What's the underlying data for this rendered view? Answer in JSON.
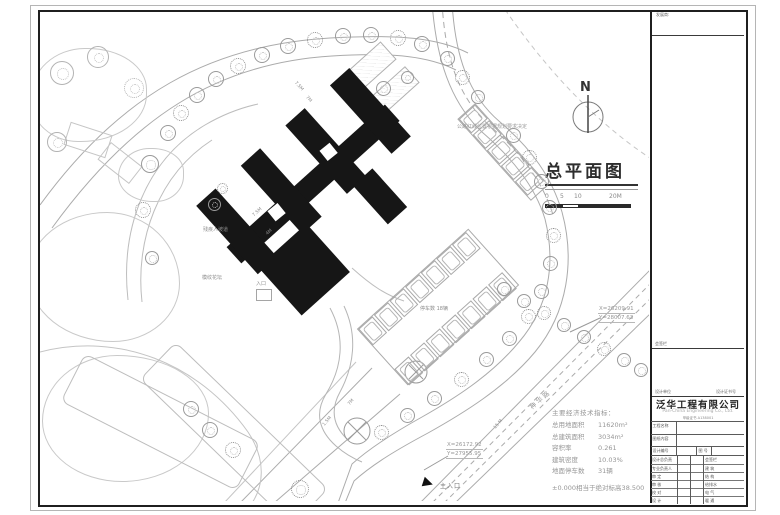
{
  "drawing": {
    "title": "总平面图",
    "north_label": "N",
    "scale_ticks": [
      "0",
      "5",
      "10",
      "20M"
    ],
    "road_note": "公路红线位置根据规划要求决定",
    "road_name": "神华路",
    "coord_markers": [
      {
        "x": "X=26209.91",
        "y": "Y=28007.63"
      },
      {
        "x": "X=26172.92",
        "y": "Y=27955.95"
      }
    ],
    "labels": {
      "main_entrance": "主入口",
      "entrance": "入口",
      "ramp": "残疾人坡道",
      "flower_bed": "模纹花坛",
      "parking_count": "停车数 18辆"
    },
    "dimensions": [
      "7.5M",
      "7M",
      "7.5M",
      "4M",
      "1.5M",
      "7M",
      "15 M"
    ],
    "indicators": {
      "heading": "主要经济技术指标：",
      "rows": [
        {
          "label": "总用地面积",
          "value": "11620m²"
        },
        {
          "label": "总建筑面积",
          "value": "3034m²"
        },
        {
          "label": "容积率",
          "value": "0.261"
        },
        {
          "label": "建筑密度",
          "value": "10.03%"
        },
        {
          "label": "地面停车数",
          "value": "31辆"
        }
      ],
      "datum_note": "±0.000相当于绝对标高38.500"
    }
  },
  "titleblock": {
    "developer_label": "发展商:",
    "sign_area_label": "会签栏",
    "unit_label": "设计单位",
    "cert_label": "设计证书号",
    "company_cn": "泛华工程有限公司",
    "company_en": "Pan-China Engineering Co., Ltd.",
    "cert_no": "甲级证书 A138001",
    "project_label": "工程名称",
    "content_label": "图纸内容",
    "design_no_label": "设计编号",
    "fig_no_label": "图 号",
    "staff_rows": [
      "设计总负责",
      "专业负责人",
      "审 定",
      "审 核",
      "校 对",
      "设 计"
    ],
    "discipline_rows": [
      "会签栏",
      "建 筑",
      "结 构",
      "给排水",
      "电 气",
      "暖 通"
    ]
  }
}
